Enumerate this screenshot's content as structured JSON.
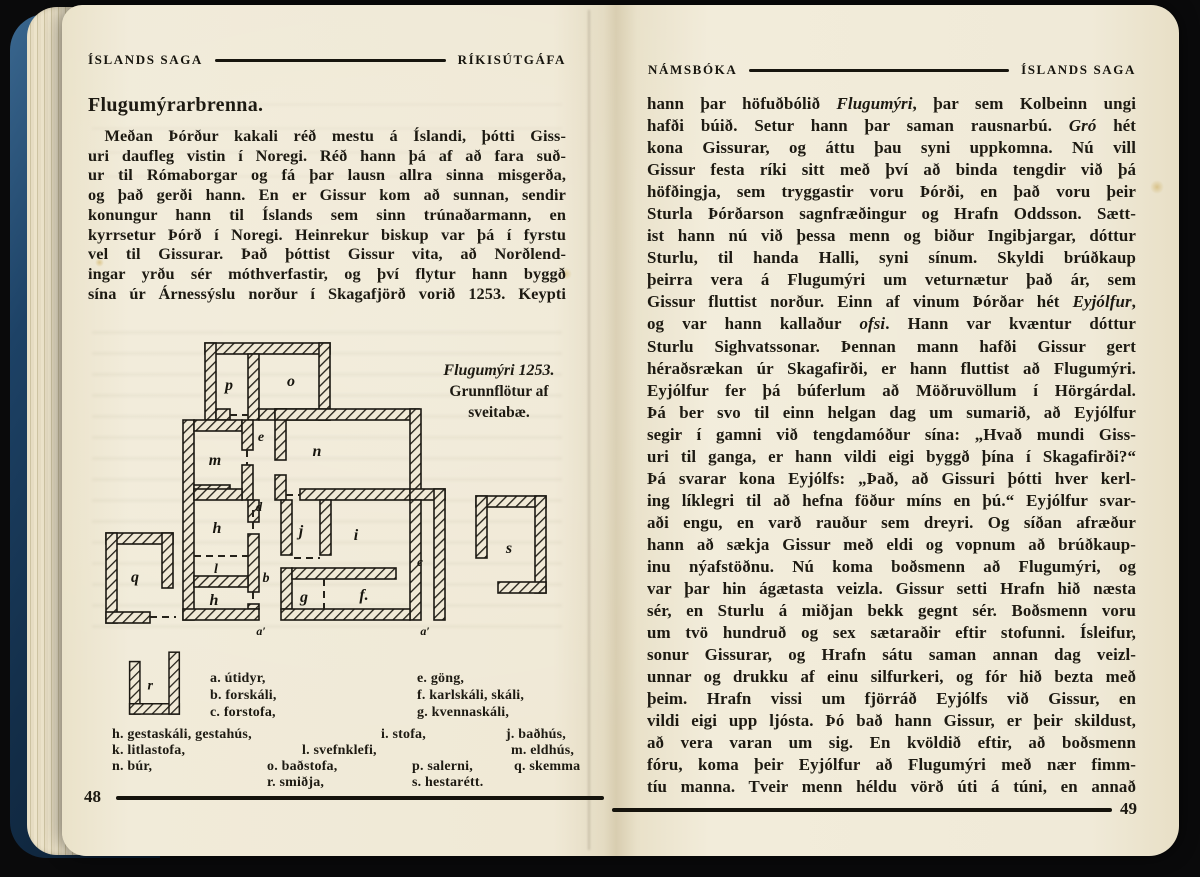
{
  "book": {
    "left_page": {
      "header_left": "ÍSLANDS SAGA",
      "header_right": "RÍKISÚTGÁFA",
      "heading": "Flugumýrarbrenna.",
      "paragraph_lines": [
        "Meðan Þórður kakali réð mestu á Íslandi, þótti Giss-",
        "uri daufleg vistin í Noregi. Réð hann þá af að fara suð-",
        "ur til Rómaborgar og fá þar lausn allra sinna misgerða,",
        "og það gerði hann. En er Gissur kom að sunnan, sendir",
        "konungur hann til Íslands sem sinn trúnaðarmann, en",
        "kyrrsetur Þórð í Noregi. Heinrekur biskup var þá í fyrstu",
        "vel til Gissurar. Það þóttist Gissur vita, að Norðlend-",
        "ingar yrðu sér móthverfastir, og því flytur hann byggð",
        "sína úr Árnessýslu norður í Skagafjörð vorið 1253. Keypti"
      ],
      "figure": {
        "caption_line1": "Flugumýri 1253.",
        "caption_line2": "Grunnflötur af",
        "caption_line3": "sveitabæ.",
        "rooms": {
          "p": "p",
          "o": "o",
          "e": "e",
          "m": "m",
          "n": "n",
          "d": "d",
          "h_upper": "h",
          "j": "j",
          "i": "i",
          "l": "l",
          "b": "b",
          "c": "c",
          "h_lower": "h",
          "g": "g",
          "f": "f.",
          "q": "q",
          "s": "s",
          "r": "r",
          "door_left": "a′",
          "door_right": "a′"
        }
      },
      "legend": {
        "a": "a. útidyr,",
        "b": "b. forskáli,",
        "c": "c. forstofa,",
        "e": "e. göng,",
        "f": "f. karlskáli, skáli,",
        "g": "g. kvennaskáli,",
        "h": "h. gestaskáli, gestahús,",
        "i": "i. stofa,",
        "j": "j. baðhús,",
        "k": "k. litlastofa,",
        "l": "l. svefnklefi,",
        "m": "m. eldhús,",
        "n": "n. búr,",
        "o": "o. baðstofa,",
        "p": "p. salerni,",
        "q": "q. skemma",
        "r": "r. smiðja,",
        "s": "s. hestarétt."
      },
      "page_number": "48"
    },
    "right_page": {
      "header_left": "NÁMSBÓKA",
      "header_right": "ÍSLANDS SAGA",
      "lines": [
        "hann þar höfuðbólið *Flugumýri*, þar sem Kolbeinn ungi",
        "hafði búið. Setur hann þar saman rausnarbú. *Gró* hét",
        "kona Gissurar, og áttu þau syni uppkomna. Nú vill",
        "Gissur festa ríki sitt með því að binda tengdir við þá",
        "höfðingja, sem tryggastir voru Þórði, en það voru þeir",
        "Sturla Þórðarson sagnfræðingur og Hrafn Oddsson. Sætt-",
        "ist hann nú við þessa menn og biður Ingibjargar, dóttur",
        "Sturlu, til handa Halli, syni sínum. Skyldi brúðkaup",
        "þeirra vera á Flugumýri um veturnætur það ár, sem",
        "Gissur fluttist norður. Einn af vinum Þórðar hét *Eyjólfur*,",
        "og var hann kallaður *ofsi*. Hann var kvæntur dóttur",
        "Sturlu Sighvatssonar. Þennan mann hafði Gissur gert",
        "héraðsrækan úr Skagafirði, er hann fluttist að Flugumýri.",
        "Eyjólfur fer þá búferlum að Möðruvöllum í Hörgárdal.",
        "Þá ber svo til einn helgan dag um sumarið, að Eyjólfur",
        "segir í gamni við tengdamóður sína: „Hvað mundi Giss-",
        "uri til ganga, er hann vildi eigi byggð þína í Skagafirði?“",
        "Þá svarar kona Eyjólfs: „Það, að Gissuri þótti hver kerl-",
        "ing líklegri til að hefna föður míns en þú.“ Eyjólfur svar-",
        "aði engu, en varð rauður sem dreyri. Og síðan afræður",
        "hann að sækja Gissur með eldi og vopnum að brúðkaup-",
        "inu nýafstöðnu. Nú koma boðsmenn að Flugumýri, og",
        "var þar hin ágætasta veizla. Gissur setti Hrafn hið næsta",
        "sér, en Sturlu á miðjan bekk gegnt sér. Boðsmenn voru",
        "um tvö hundruð og sex sætaraðir eftir stofunni. Ísleifur,",
        "sonur Gissurar, og Hrafn sátu saman annan dag veizl-",
        "unnar og drukku af einu silfurkeri, og fór hið bezta með",
        "þeim. Hrafn vissi um fjörráð Eyjólfs við Gissur, en",
        "vildi eigi upp ljósta. Þó bað hann Gissur, er þeir skildust,",
        "að vera varan um sig. En kvöldið eftir, að boðsmenn",
        "fóru, koma þeir Eyjólfur að Flugumýri með nær fimm-",
        "tíu manna. Tveir menn héldu vörð úti á túni, en annað"
      ],
      "page_number": "49"
    }
  }
}
